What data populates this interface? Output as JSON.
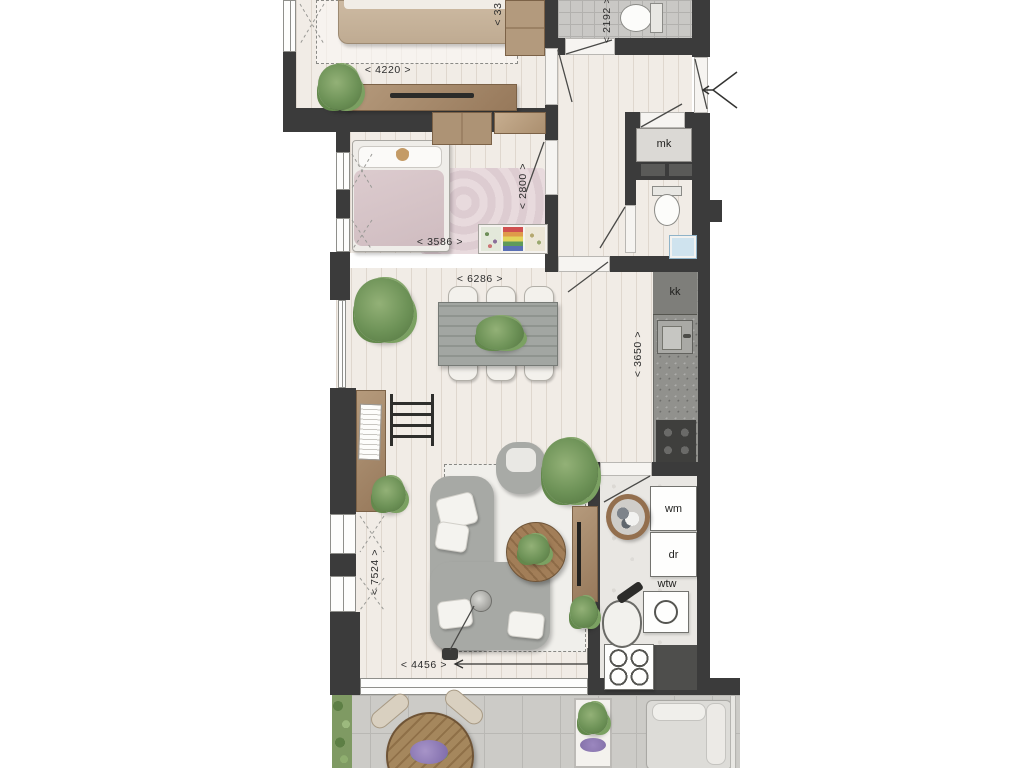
{
  "title": "apartment-floor-plan",
  "colors": {
    "wall": "#3b3b3b",
    "wood_accent": "#a98c6d",
    "wood_floor": "#f1ece6",
    "tile_grey": "#c9c8c5",
    "terrace_stone": "#cccbc7",
    "sofa_grey": "#a7a9a5",
    "plant_green": "#6d9257"
  },
  "dimensions": {
    "master_width": "< 4220 >",
    "master_depth": "< 33",
    "toilet_width": "< 2192 >",
    "kids_width": "< 3586 >",
    "kids_depth": "< 2800 >",
    "dining_width": "< 6286 >",
    "kitchen_depth": "< 3650 >",
    "living_depth": "< 7524 >",
    "living_width": "< 4456 >"
  },
  "labels": {
    "meter_cupboard": "mk",
    "kitchen_unit": "kk",
    "washing_machine": "wm",
    "dryer": "dr",
    "heat_recovery": "wtw",
    "heat_pump": "wp"
  }
}
